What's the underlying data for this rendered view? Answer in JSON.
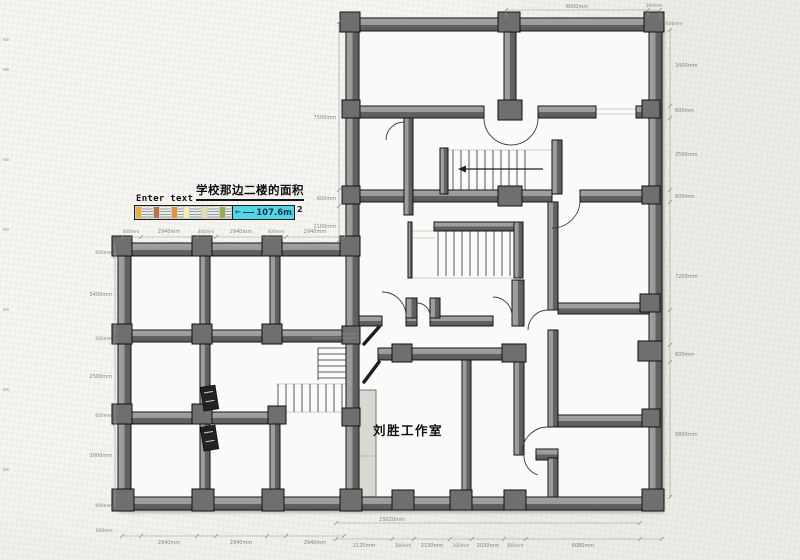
{
  "app": {
    "canvas_hint": "Enter text"
  },
  "title": {
    "text": "学校那边二楼的面积"
  },
  "area_annotation": {
    "value": "107.6m",
    "sup": "2"
  },
  "room_labels": {
    "studio": "刘胜工作室"
  },
  "palette": [
    "#e8b23a",
    "stripe",
    "stripe",
    "#b4764a",
    "stripe",
    "stripe",
    "#df9440",
    "stripe",
    "#f2eeb0",
    "stripe",
    "stripe",
    "#e0e0a8",
    "stripe",
    "stripe",
    "#93ad52",
    "stripe"
  ],
  "colors": {
    "paper": "#ecebe6",
    "floor": "#fafaf8",
    "wall_light": "#9e9e9e",
    "wall_dark": "#636363",
    "column": "#6f6f6f",
    "outline": "#141414",
    "highlight": "#50d6e6",
    "dim_text": "#85857c",
    "shaft": "#dad8d2"
  },
  "dims": {
    "top": [
      "6000mm",
      "300mm",
      "600mm"
    ],
    "right": [
      "3400mm",
      "600mm",
      "2500mm",
      "600mm",
      "7200mm",
      "600mm",
      "6800mm"
    ],
    "left_main": [
      "7500mm",
      "600mm",
      "2100mm"
    ],
    "wing_top": [
      "400mm",
      "2940mm",
      "400mm",
      "2940mm",
      "400mm",
      "2940mm"
    ],
    "wing_left": [
      "600mm",
      "3400mm",
      "600mm",
      "2500mm",
      "600mm",
      "3000mm",
      "600mm"
    ],
    "bottom_wing": [
      "600mm",
      "2940mm",
      "2940mm",
      "2940mm"
    ],
    "bottom_main": [
      "2120mm",
      "300mm",
      "2130mm",
      "300mm",
      "2030mm",
      "300mm",
      "6080mm"
    ],
    "bottom_total": "25020mm"
  }
}
